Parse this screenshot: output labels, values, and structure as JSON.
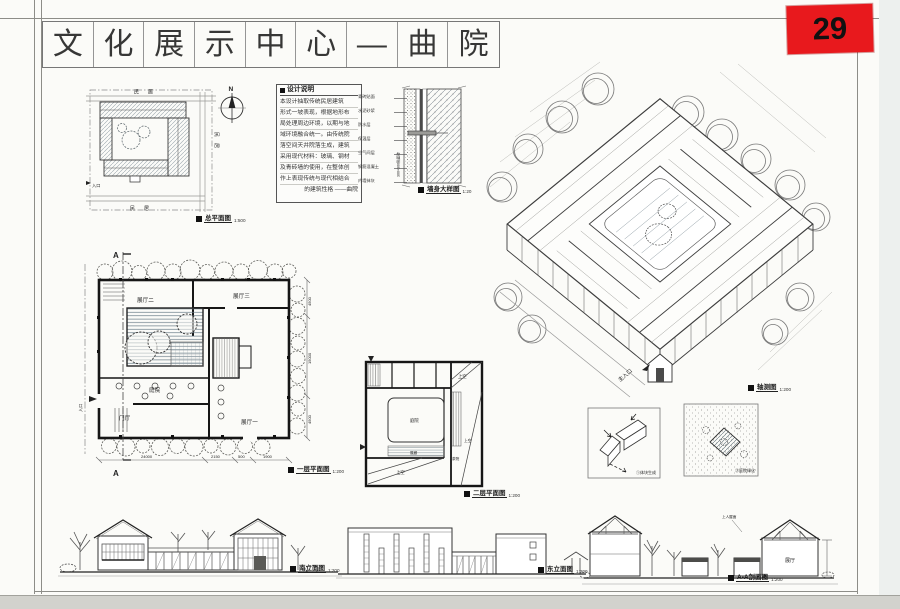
{
  "page": {
    "number": "29"
  },
  "title": {
    "chars": [
      "文",
      "化",
      "展",
      "示",
      "中",
      "心",
      "—",
      "曲",
      "院"
    ]
  },
  "site_plan": {
    "caption": "总平面图",
    "scale": "1:500",
    "north_label": "N",
    "neighbor_top": "民居",
    "neighbor_right": "民居",
    "neighbor_bottom": "民居",
    "entry_label": "入口"
  },
  "design_notes": {
    "title": "设计说明",
    "lines": [
      "本设计抽取传统民居建筑",
      "形式一坡表现，根据地形布",
      "局处理周边环境，以期与地",
      "域环境融合统一。由传统院",
      "落空间天井院落生成，建筑",
      "采用现代材料：玻璃、钢材",
      "及青砖墙的使用，在整体创",
      "作上表现传统与现代相结合",
      "的建筑性格 ——曲院"
    ]
  },
  "wall_detail": {
    "caption": "墙身大样图",
    "scale": "1:20",
    "layers": [
      "青砖贴面",
      "水泥砂浆",
      "防水层",
      "保温层",
      "空气间层",
      "钢筋混凝土",
      "内墙抹灰"
    ],
    "side_note": "300×300贴面砖"
  },
  "axonometric": {
    "caption": "轴测图",
    "scale": "1:200",
    "entry_label": "主入口"
  },
  "floor_plan_1": {
    "caption": "一层平面图",
    "scale": "1:200",
    "rooms": {
      "hall2": "展厅二",
      "hall3": "展厅三",
      "court": "庭院",
      "lobby": "门厅",
      "hall1": "展厅一"
    },
    "section_mark": "A",
    "entry_label": "入口",
    "dims_bottom": [
      "24000",
      "2150",
      "500",
      "1900"
    ],
    "dims_right": [
      "4500",
      "15000",
      "4500"
    ]
  },
  "floor_plan_2": {
    "caption": "二层平面图",
    "scale": "1:200",
    "rooms": {
      "court": "庭院",
      "gallery": "展廊",
      "tea": "茶院",
      "void1": "上空",
      "void2": "上空",
      "void3": "上空"
    }
  },
  "diagrams": {
    "massing": {
      "caption": "①体块生成"
    },
    "greening": {
      "caption": "②庭院绿化"
    }
  },
  "elevations": {
    "south": {
      "caption": "南立面图",
      "scale": "1:200"
    },
    "east": {
      "caption": "东立面图",
      "scale": "1:200"
    }
  },
  "section": {
    "caption": "A-A剖面图",
    "scale": "1:200",
    "hall_label": "展厅",
    "roof_note": "上人屋面"
  }
}
